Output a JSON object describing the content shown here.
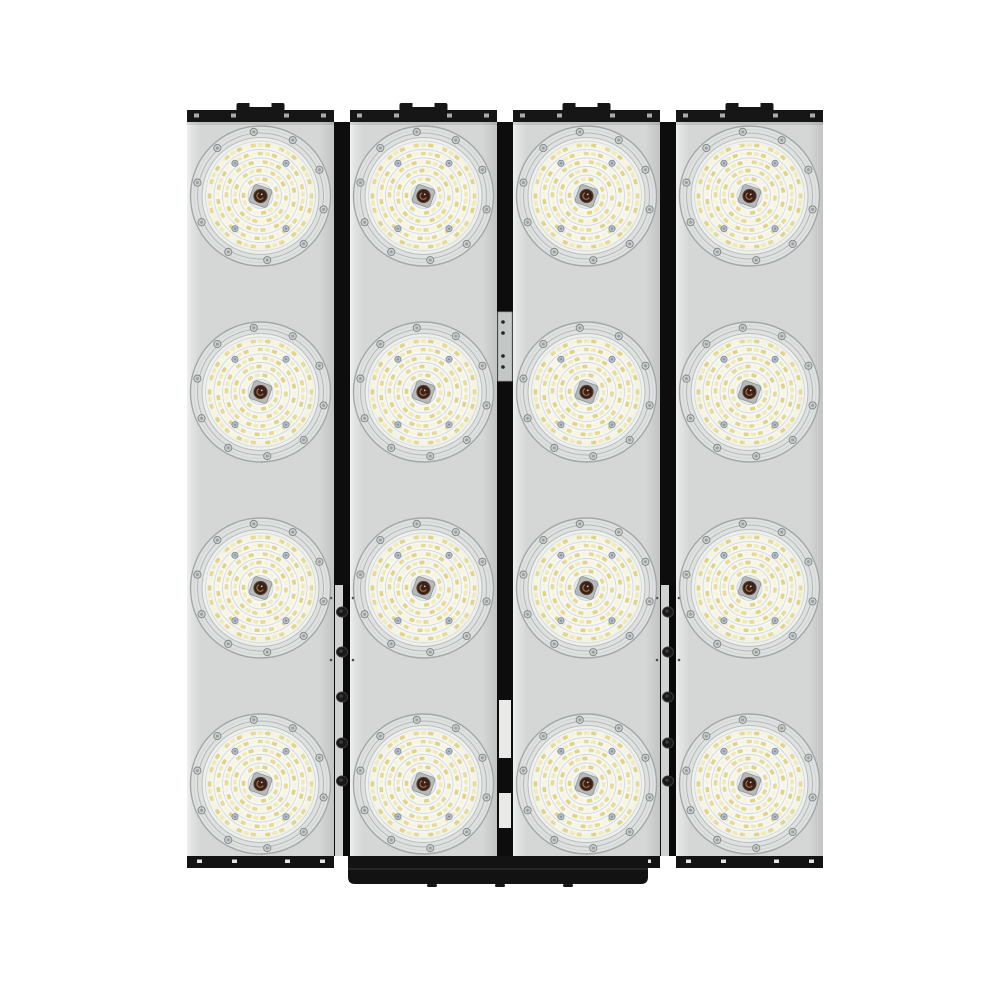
{
  "scene": {
    "type": "product-photo",
    "subject": "Modular LED high-bay floodlight array, front view, 4 panels x 4 round LED modules (16 modules total) on white background",
    "background_color": "#ffffff"
  },
  "fixture": {
    "panel_count": 4,
    "module_rows": 4,
    "module_columns": 4,
    "total_led_modules": 16,
    "colors": {
      "panel": "#d5d7d6",
      "panel_edge_light": "#eff1f0",
      "panel_edge_dark": "#c2c4c3",
      "frame": "#161616",
      "frame_bottom": "#131313",
      "gap_dark": "#0d0d0d",
      "gap_light": "#d0d2d1",
      "bracket": "#121212",
      "bracket_edge": "#262626",
      "top_screw": "#a8acab",
      "bottom_screw": "#e6e6e4",
      "connector_plate": "#c3c7c6",
      "connector_plate_stroke": "#9b9f9e",
      "hinge_knob": "#181818",
      "hinge_knob_stroke": "#3a3a3a",
      "pin_dot": "#4a4a4a"
    },
    "geometry": {
      "left": 187,
      "panel_width": 147,
      "gap_width": 16,
      "panel_top": 122,
      "panel_bottom": 856,
      "top_rail": {
        "y": 110,
        "height": 12,
        "bump_width": 48,
        "bump_rise": 7,
        "notch_width": 22,
        "notch_depth": 4,
        "screw_offsets": [
          7,
          44,
          97,
          134
        ]
      },
      "bottom_rail": {
        "y": 856,
        "height": 12,
        "screw_offsets": [
          10,
          45,
          98,
          133
        ]
      },
      "bracket": {
        "x1": 348,
        "x2": 648,
        "top": 868,
        "bottom": 884,
        "corner_radius": 7,
        "notch_xs": [
          432,
          500,
          568
        ]
      },
      "row_centers": [
        196,
        392,
        588,
        784
      ],
      "module_radius": 70
    },
    "gaps": [
      {
        "type": "hinge",
        "light_from_y": 585,
        "knob_ys": [
          612,
          652,
          697,
          743,
          781
        ],
        "pin_dot_ys": [
          598,
          660
        ]
      },
      {
        "type": "connector",
        "plate_y1": 312,
        "plate_y2": 381,
        "dot_ys": [
          322,
          333,
          356,
          367
        ],
        "light_segments": [
          [
            700,
            758
          ],
          [
            793,
            828
          ]
        ]
      },
      {
        "type": "hinge",
        "light_from_y": 585,
        "knob_ys": [
          612,
          652,
          697,
          743,
          781
        ],
        "pin_dot_ys": [
          598,
          660
        ]
      }
    ]
  },
  "led_module": {
    "bezel_color": "#dfe1e0",
    "bezel_stroke": "#a2a8a8",
    "bezel_ring_stroke_outer": "#cfd5d4",
    "bezel_ring_stroke_inner": "#b2b8b8",
    "face_color_center": "#f6f7f3",
    "face_color_edge": "#e9ebe7",
    "face_stroke": "#b9bfbe",
    "rib_stroke": "#d4dad9",
    "rim_screw_count": 10,
    "rim_screw_radius_pos": 64.5,
    "rim_screw_fill": "#c9cdcc",
    "rim_screw_stroke": "#7f8587",
    "inner_screw_angles": [
      52,
      128,
      232,
      308
    ],
    "inner_screw_radius_pos": 41.5,
    "inner_screw_fill": "#b7c0cc",
    "inner_screw_stroke": "#7c8795",
    "led_palette": [
      "#e8da90",
      "#f2eab6",
      "#e3d483",
      "#f8f4d8"
    ],
    "led_rings": [
      {
        "radius": 51,
        "count": 44
      },
      {
        "radius": 42.5,
        "count": 37
      },
      {
        "radius": 34,
        "count": 30
      },
      {
        "radius": 25.5,
        "count": 22
      },
      {
        "radius": 17,
        "count": 14
      }
    ],
    "rib_radii": [
      55,
      46.5,
      38,
      29.5,
      21
    ],
    "center_hub_color": "#e9ebe8",
    "center_plate_color": "#b5b9ba",
    "center_plate_stroke": "#8e9494",
    "center_core_color": "#38221a",
    "center_core_stroke": "#5d4030",
    "center_swirl_color": "#b27445",
    "center_glint_color": "#d8c8b6"
  }
}
